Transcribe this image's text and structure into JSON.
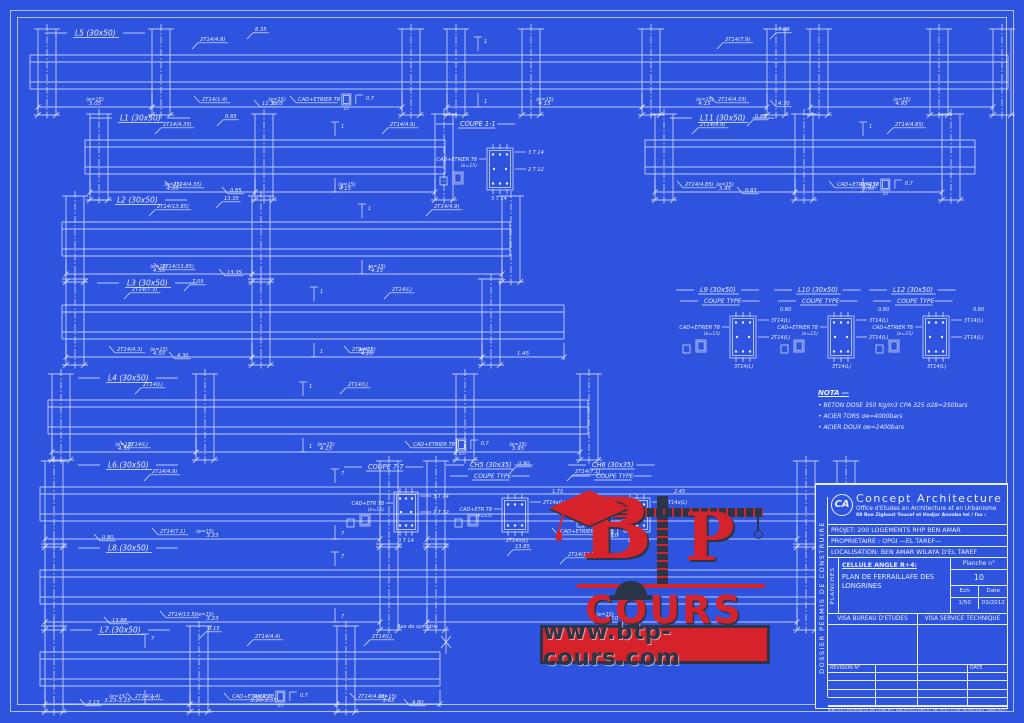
{
  "colors": {
    "bg": "#2e53de",
    "line": "#e9efff",
    "red": "#d6232b",
    "navy": "#2b3547"
  },
  "e15_label": "(e=15)",
  "axis_label": "Axe de symetrie",
  "stirrup": {
    "dim": "0.7",
    "w": "25"
  },
  "beams": [
    {
      "id": "L5",
      "label": "L5 (30x50)",
      "x": 30,
      "y": 55,
      "w": 978,
      "labelDx": 45,
      "cols": [
        8,
        122,
        372,
        417,
        492,
        612,
        737,
        780,
        900,
        963
      ],
      "anns": [
        {
          "t": "8.35",
          "dx": 225,
          "dy": -24
        },
        {
          "t": "2T14(4.8)",
          "dx": 170,
          "dy": -14
        },
        {
          "t": "7.80",
          "dx": 748,
          "dy": -24
        },
        {
          "t": "2T14(7.9)",
          "dx": 695,
          "dy": -14
        },
        {
          "t": "2T14(1.4)",
          "dx": 172,
          "dy": 46
        },
        {
          "t": "11.35",
          "dx": 232,
          "dy": 50
        },
        {
          "t": "CAD+ETRIER T8",
          "dx": 268,
          "dy": 46,
          "stirrup": true
        },
        {
          "t": "2T14(4.55)",
          "dx": 688,
          "dy": 46
        },
        {
          "t": "4.70",
          "dx": 748,
          "dy": 50
        }
      ],
      "dims": [
        {
          "x1": 8,
          "x2": 122,
          "t": "3.05"
        },
        {
          "x1": 122,
          "x2": 372,
          "t": "3.05"
        },
        {
          "x1": 417,
          "x2": 612,
          "t": "4.15"
        },
        {
          "x1": 612,
          "x2": 737,
          "t": "4.15"
        },
        {
          "x1": 780,
          "x2": 963,
          "t": "4.95"
        }
      ],
      "e15": [
        65,
        247,
        515,
        675,
        872
      ],
      "cuts": [
        {
          "dx": 448,
          "n": "1"
        }
      ]
    },
    {
      "id": "L1",
      "label": "L1 (30x50)",
      "x": 85,
      "y": 140,
      "w": 360,
      "labelDx": 35,
      "cols": [
        5,
        170,
        350
      ],
      "anns": [
        {
          "t": "2T14(4.35)",
          "dx": 78,
          "dy": -14
        },
        {
          "t": "0.85",
          "dx": 140,
          "dy": -22
        },
        {
          "t": "2T14(4.9)",
          "dx": 305,
          "dy": -14
        },
        {
          "t": "2T14(4.35)",
          "dx": 88,
          "dy": 46
        },
        {
          "t": "0.85",
          "dx": 145,
          "dy": 52
        }
      ],
      "dims": [
        {
          "x1": 5,
          "x2": 170,
          "t": "4.35"
        },
        {
          "x1": 170,
          "x2": 350,
          "t": "4.15"
        }
      ],
      "e15": [
        88,
        262
      ],
      "cuts": [
        {
          "dx": 250,
          "n": "1"
        }
      ]
    },
    {
      "id": "L11",
      "label": "L11 (30x50)",
      "x": 645,
      "y": 140,
      "w": 330,
      "labelDx": 55,
      "cols": [
        10,
        150,
        297
      ],
      "anns": [
        {
          "t": "2T14(4.9)",
          "dx": 55,
          "dy": -14
        },
        {
          "t": "0.85",
          "dx": 110,
          "dy": -22
        },
        {
          "t": "2T14(4.85)",
          "dx": 250,
          "dy": -14
        },
        {
          "t": "2T14(4.85)",
          "dx": 40,
          "dy": 46
        },
        {
          "t": "0.83",
          "dx": 100,
          "dy": 52
        },
        {
          "t": "CAD+ETRIER T8",
          "dx": 192,
          "dy": 46,
          "stirrup": true
        }
      ],
      "dims": [
        {
          "x1": 10,
          "x2": 150,
          "t": "3.95"
        },
        {
          "x1": 150,
          "x2": 297,
          "t": "3.95"
        }
      ],
      "e15": [
        80,
        224
      ],
      "cuts": [
        {
          "dx": 218,
          "n": "1"
        }
      ]
    },
    {
      "id": "L2",
      "label": "L2 (30x50)",
      "x": 62,
      "y": 222,
      "w": 448,
      "labelDx": 55,
      "cols": [
        4,
        190,
        440
      ],
      "anns": [
        {
          "t": "2T14(13.85)",
          "dx": 95,
          "dy": -14
        },
        {
          "t": "13.35",
          "dx": 162,
          "dy": -22
        },
        {
          "t": "2T14(4.9)",
          "dx": 372,
          "dy": -14
        },
        {
          "t": "2T14(13.85)",
          "dx": 100,
          "dy": 46
        },
        {
          "t": "13.35",
          "dx": 165,
          "dy": 52
        }
      ],
      "dims": [
        {
          "x1": 4,
          "x2": 190,
          "t": "4.55"
        },
        {
          "x1": 190,
          "x2": 440,
          "t": "4.15"
        }
      ],
      "e15": [
        97,
        315
      ],
      "cuts": [
        {
          "dx": 300,
          "n": "1"
        }
      ]
    },
    {
      "id": "L3",
      "label": "L3 (30x50)",
      "x": 62,
      "y": 305,
      "w": 502,
      "labelDx": 65,
      "cols": [
        4,
        190,
        420
      ],
      "anns": [
        {
          "t": "2T14(7.3)",
          "dx": 70,
          "dy": -14
        },
        {
          "t": "7.05",
          "dx": 130,
          "dy": -22
        },
        {
          "t": "2T14(L)",
          "dx": 330,
          "dy": -14
        },
        {
          "t": "2T14(4.3)",
          "dx": 55,
          "dy": 46
        },
        {
          "t": "4.30",
          "dx": 115,
          "dy": 52
        },
        {
          "t": "2T14(L)",
          "dx": 290,
          "dy": 46
        }
      ],
      "dims": [
        {
          "x1": 4,
          "x2": 190,
          "t": "4.55"
        },
        {
          "x1": 190,
          "x2": 420,
          "t": "4.15"
        },
        {
          "x1": 420,
          "x2": 502,
          "t": "1.45"
        }
      ],
      "e15": [
        97,
        305
      ],
      "cuts": [
        {
          "dx": 252,
          "n": "1"
        }
      ]
    },
    {
      "id": "L4",
      "label": "L4 (30x50)",
      "x": 48,
      "y": 400,
      "w": 540,
      "labelDx": 60,
      "cols": [
        4,
        148,
        408,
        532
      ],
      "anns": [
        {
          "t": "2T14(L)",
          "dx": 95,
          "dy": -14
        },
        {
          "t": "2T14(L)",
          "dx": 300,
          "dy": -14
        },
        {
          "t": "2T14(L)",
          "dx": 80,
          "dy": 46
        },
        {
          "t": "CAD+ETRIER T8",
          "dx": 365,
          "dy": 46,
          "stirrup": true
        }
      ],
      "dims": [
        {
          "x1": 4,
          "x2": 148,
          "t": "4.55"
        },
        {
          "x1": 148,
          "x2": 408,
          "t": "4.15"
        },
        {
          "x1": 408,
          "x2": 532,
          "t": "3.95"
        }
      ],
      "e15": [
        76,
        278,
        470
      ],
      "cuts": [
        {
          "dx": 255,
          "n": "1"
        }
      ]
    },
    {
      "id": "L6",
      "label": "L6.(30x50)",
      "x": 40,
      "y": 487,
      "w": 805,
      "labelDx": 68,
      "cols": [
        5,
        340,
        387,
        757,
        797
      ],
      "anns": [
        {
          "t": "2T14(4.9)",
          "dx": 112,
          "dy": -14
        },
        {
          "t": "0.90",
          "dx": 478,
          "dy": -22
        },
        {
          "t": "2T14(7.1)",
          "dx": 535,
          "dy": -14
        },
        {
          "t": "0.80",
          "dx": 62,
          "dy": 52
        },
        {
          "t": "2T14(7.1)",
          "dx": 120,
          "dy": 46
        },
        {
          "t": "CAD+ETRIER T8",
          "dx": 520,
          "dy": 46,
          "stirrup": true
        }
      ],
      "dims": [
        {
          "x1": 5,
          "x2": 340,
          "t": "3.23"
        },
        {
          "x1": 387,
          "x2": 757,
          "t": "5.10"
        }
      ],
      "e15": [
        165,
        565
      ],
      "cuts": [
        {
          "dx": 295,
          "n": "7"
        }
      ]
    },
    {
      "id": "L8",
      "label": "L8.(30x50)",
      "x": 40,
      "y": 570,
      "w": 805,
      "labelDx": 68,
      "cols": [
        5,
        340,
        387,
        757,
        797
      ],
      "anns": [
        {
          "t": "13.85",
          "dx": 475,
          "dy": -22
        },
        {
          "t": "2T14(13.5)",
          "dx": 528,
          "dy": -14
        },
        {
          "t": "13.88",
          "dx": 72,
          "dy": 52
        },
        {
          "t": "2T14(13.5)",
          "dx": 128,
          "dy": 46
        }
      ],
      "dims": [
        {
          "x1": 5,
          "x2": 340,
          "t": "3.23"
        },
        {
          "x1": 387,
          "x2": 757,
          "t": "5.10"
        }
      ],
      "e15": [
        165,
        565
      ],
      "cuts": [
        {
          "dx": 295,
          "n": "7"
        }
      ]
    },
    {
      "id": "L7",
      "label": "L7.(30x50)",
      "x": 40,
      "y": 652,
      "w": 400,
      "labelDx": 60,
      "cols": [
        5,
        150,
        297
      ],
      "anns": [
        {
          "t": "8.15",
          "dx": 168,
          "dy": -22
        },
        {
          "t": "2T14(4.4)",
          "dx": 215,
          "dy": -14
        },
        {
          "t": "2T14(L)",
          "dx": 332,
          "dy": -14
        },
        {
          "t": "2.15",
          "dx": 48,
          "dy": 52
        },
        {
          "t": "2T14(2.4)",
          "dx": 95,
          "dy": 46
        },
        {
          "t": "CAD+ETRIER T8",
          "dx": 192,
          "dy": 46,
          "stirrup": true
        },
        {
          "t": "2T14(4.85)",
          "dx": 318,
          "dy": 46
        },
        {
          "t": "4.80",
          "dx": 372,
          "dy": 52
        }
      ],
      "dims": [
        {
          "x1": 5,
          "x2": 150,
          "t": "3.23-3.25"
        },
        {
          "x1": 150,
          "x2": 297,
          "t": "3.20-3.35"
        },
        {
          "x1": 297,
          "x2": 400,
          "t": "3.65"
        }
      ],
      "e15": [
        78,
        222,
        348
      ],
      "cuts": [
        {
          "dx": 105,
          "n": "7"
        }
      ],
      "axis": true
    }
  ],
  "sections": [
    {
      "id": "coupe-1-1",
      "title": "COUPE 1-1",
      "tx": 460,
      "ty": 126,
      "bx": 487,
      "by": 148,
      "w": 26,
      "h": 42,
      "top": "3 T 14",
      "mid": "2 T 12",
      "bot": "3 T 14",
      "cad": "CAD+ETRIER T8",
      "cad2": "(e=15)"
    },
    {
      "id": "coupe-7-7",
      "title": "COUPE 7-7",
      "tx": 368,
      "ty": 469,
      "bx": 394,
      "by": 492,
      "w": 24,
      "h": 40,
      "top": "3 T 14",
      "mid": "1 T 12",
      "bot": "3 T 14",
      "cad": "CAD+ETR T8",
      "cad2": "(e=15)"
    },
    {
      "id": "ch5",
      "title": "CH5 (30x35)",
      "sub": "COUPE TYPE",
      "tx": 470,
      "ty": 467,
      "bx": 502,
      "by": 498,
      "w": 26,
      "h": 34,
      "top": "2T14x(L)",
      "bot": "2T14x(L)",
      "dim": "1.75",
      "cad": "CAD+ETR T8",
      "cad2": "(e=15)"
    },
    {
      "id": "ch6",
      "title": "CH6 (30x35)",
      "sub": "COUPE TYPE",
      "tx": 592,
      "ty": 467,
      "bx": 624,
      "by": 498,
      "w": 26,
      "h": 34,
      "top": "2T14x(L)",
      "bot": "2T14x(L)",
      "dim": "2.45",
      "cad": "CAD+ETR T8",
      "cad2": "(e=15)"
    },
    {
      "id": "l9",
      "title": "L9 (30x50)",
      "sub": "COUPE TYPE",
      "tx": 700,
      "ty": 292,
      "bx": 730,
      "by": 316,
      "w": 26,
      "h": 42,
      "top": "3T14(L)",
      "mid": "2T14(L)",
      "bot": "3T14(L)",
      "dim": "0.80",
      "cad": "CAD+ETRIER T8",
      "cad2": "(e=15)"
    },
    {
      "id": "l10",
      "title": "L10 (30x50)",
      "sub": "COUPE TYPE",
      "tx": 798,
      "ty": 292,
      "bx": 828,
      "by": 316,
      "w": 26,
      "h": 42,
      "top": "3T14(L)",
      "mid": "2T14(L)",
      "bot": "3T14(L)",
      "dim": "0.80",
      "cad": "CAD+ETRIER T8",
      "cad2": "(e=15)"
    },
    {
      "id": "l12",
      "title": "L12 (30x50)",
      "sub": "COUPE TYPE",
      "tx": 893,
      "ty": 292,
      "bx": 923,
      "by": 316,
      "w": 26,
      "h": 42,
      "top": "3T14(L)",
      "mid": "2T14(L)",
      "bot": "3T14(L)",
      "dim": "0.80",
      "cad": "CAD+ETRIER T8",
      "cad2": "(e=15)"
    }
  ],
  "nota": {
    "title": "NOTA —",
    "items": [
      "•  BETON DOSE 350 Kg/m3 CPA 325  σ28=250bars",
      "•  ACIER TORS    σe=4000bars",
      "•  ACIER DOUX   σe=2400bars"
    ]
  },
  "watermark": {
    "b": "B",
    "p": "P",
    "cours": "COURS",
    "url": "www.btp-cours.com"
  },
  "titleblock": {
    "republic": "REPUBLIQUE ALGERIENNE DEMOCRATIQUE ET POPULAIRE",
    "logo": "CA",
    "firm": "Concept Architecture",
    "firm_sub": "Office d'Etudes en Architecture et en Urbanisme",
    "firm_addr": "88 Rue Zighout Youcef et Hadjar Annaba        tel / fax :",
    "projet": "PROJET:  200 LOGEMENTS RHP BEN AMAR",
    "proprietaire": "PROPRIETAIRE : OPGI —EL TAREF—",
    "localisation": "LOCALISATION: BEN AMAR WILAYA D'EL TAREF",
    "dossier": "DOSSIER PERMIS DE CONSTRUIRE",
    "planches": "PLANCHES",
    "cellule": "CELLULE ANGLE R+4:",
    "plan_title": "PLAN DE FERRAILLAFE DES LONGRINES",
    "planche_label": "Planche n°",
    "planche_num": "10",
    "ech_label": "Ech",
    "date_label": "Date",
    "ech": "1/50",
    "date": "03/2012",
    "visa1": "VISA BUREAU D'ETUDES",
    "visa2": "VISA SERVICE TECHNIQUE",
    "revision": "REVISION N°",
    "rev_date": "DATE",
    "footer": "CE DOCUMENT EST PROPRIETE DE CONCEPT ARCHITECTURE ET NE PEUT ETRE REPRODUIT SANS AUTORISATION"
  }
}
